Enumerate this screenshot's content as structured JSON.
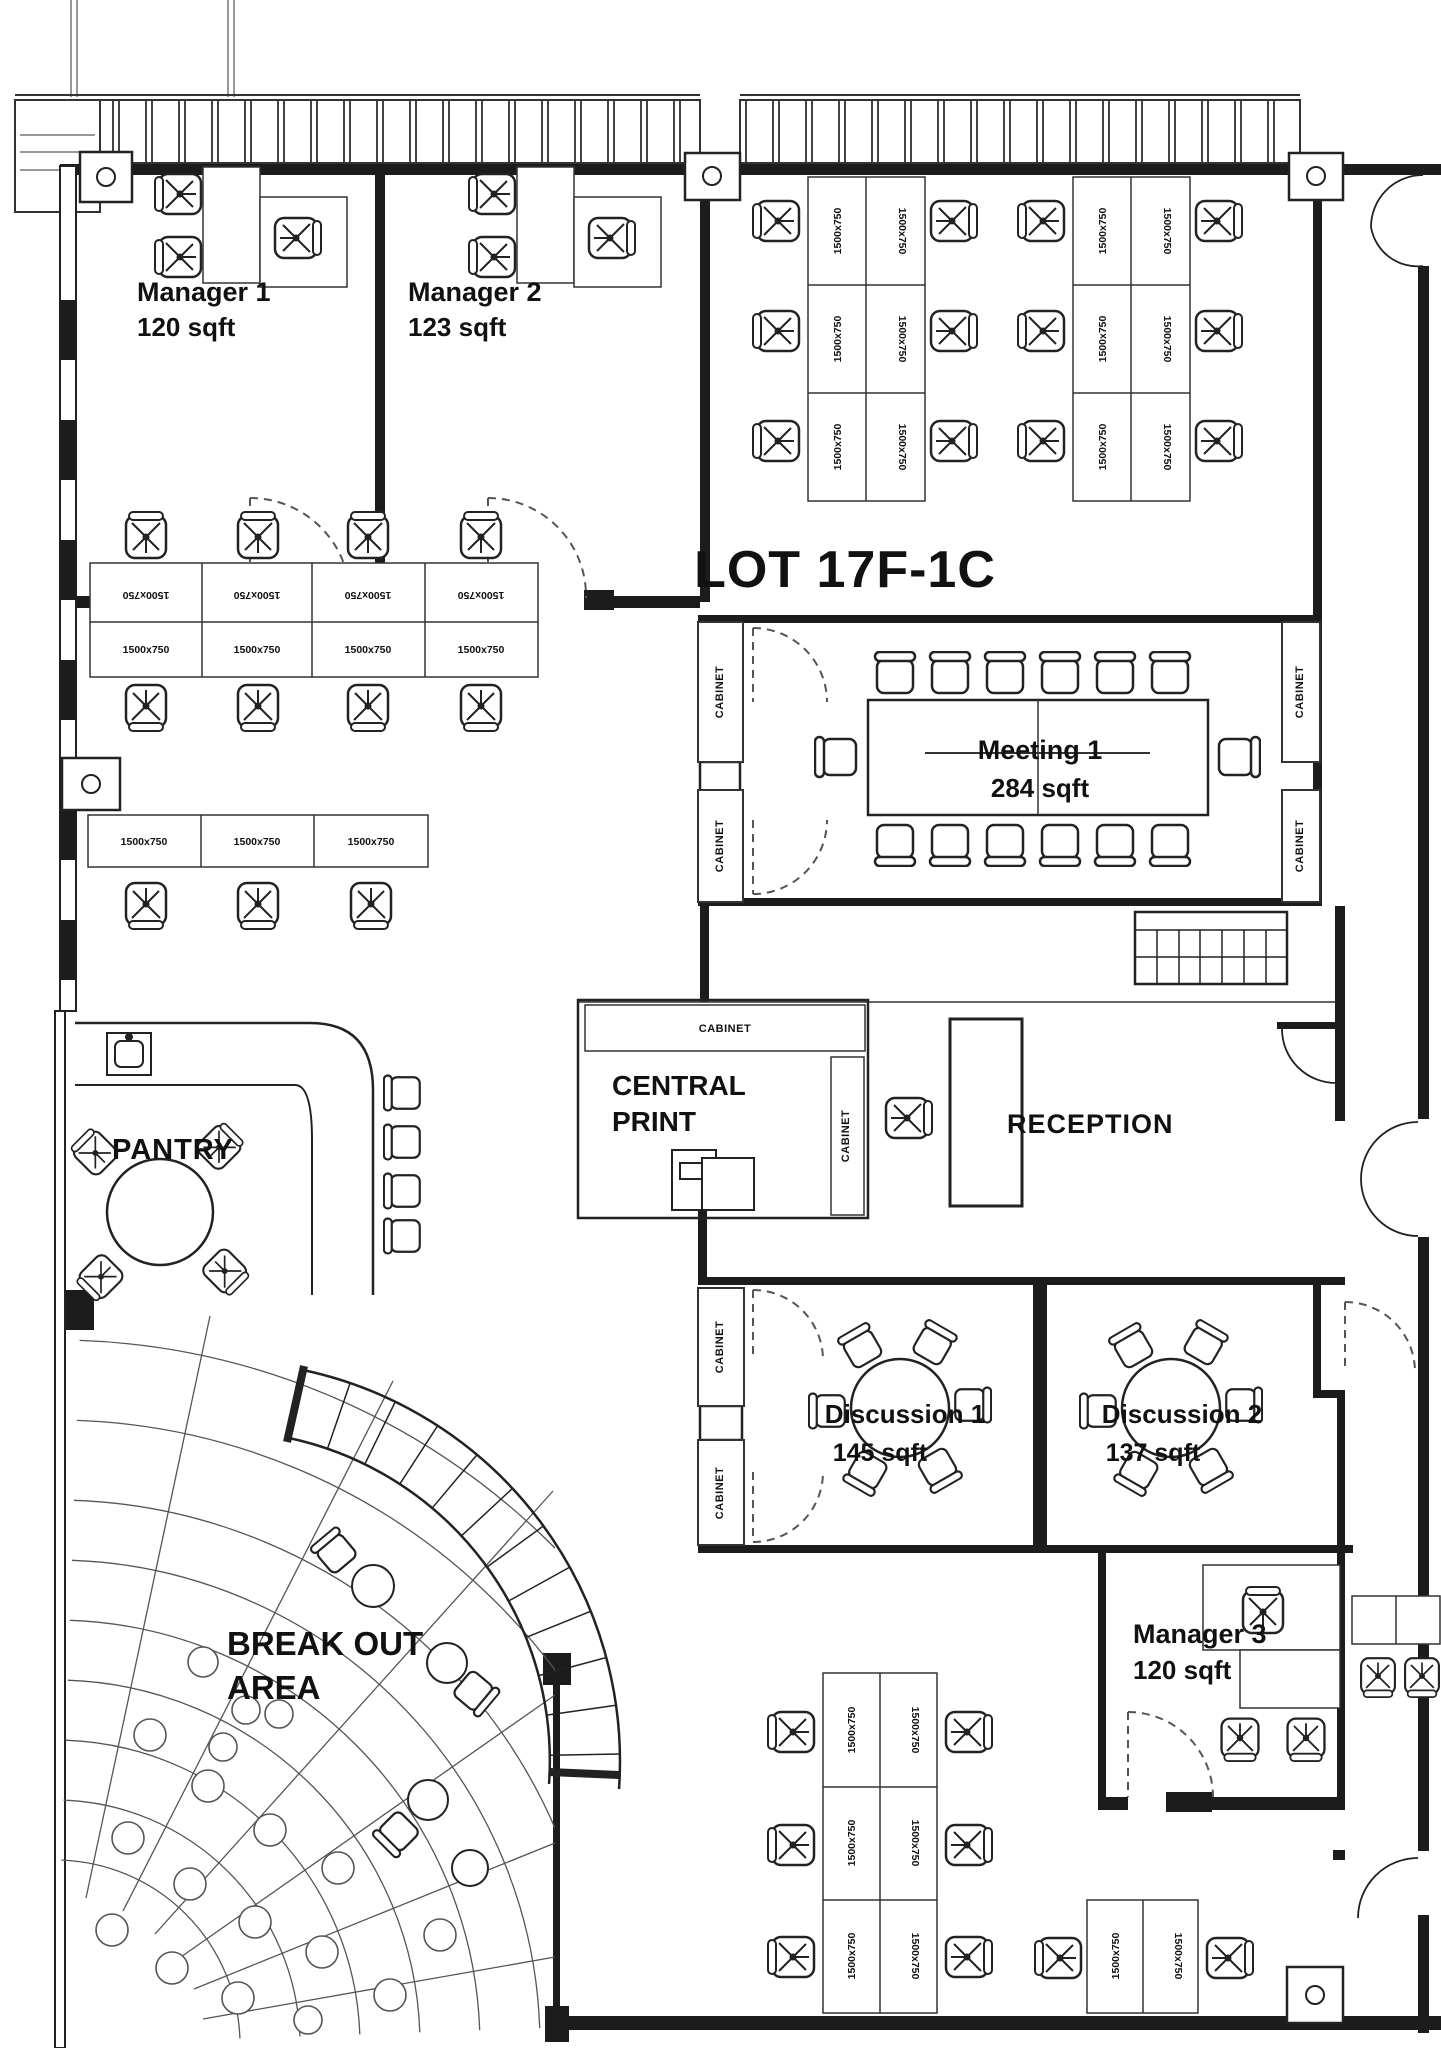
{
  "title": "LOT 17F-1C",
  "labels": {
    "desk": "1500x750",
    "cabinet": "CABINET"
  },
  "rooms": {
    "manager1": {
      "name": "Manager 1",
      "area": "120 sqft"
    },
    "manager2": {
      "name": "Manager 2",
      "area": "123 sqft"
    },
    "manager3": {
      "name": "Manager 3",
      "area": "120 sqft"
    },
    "meeting1": {
      "name": "Meeting 1",
      "area": "284 sqft"
    },
    "discussion1": {
      "name": "Discussion 1",
      "area": "145 sqft"
    },
    "discussion2": {
      "name": "Discussion 2",
      "area": "137 sqft"
    },
    "pantry": {
      "name": "PANTRY"
    },
    "central_print": {
      "name": "CENTRAL\nPRINT"
    },
    "reception": {
      "name": "RECEPTION"
    },
    "breakout": {
      "name": "BREAK OUT\nAREA"
    }
  },
  "colors": {
    "line": "#1a1a1a",
    "wall": "#1c1c1c",
    "paper": "#ffffff"
  }
}
